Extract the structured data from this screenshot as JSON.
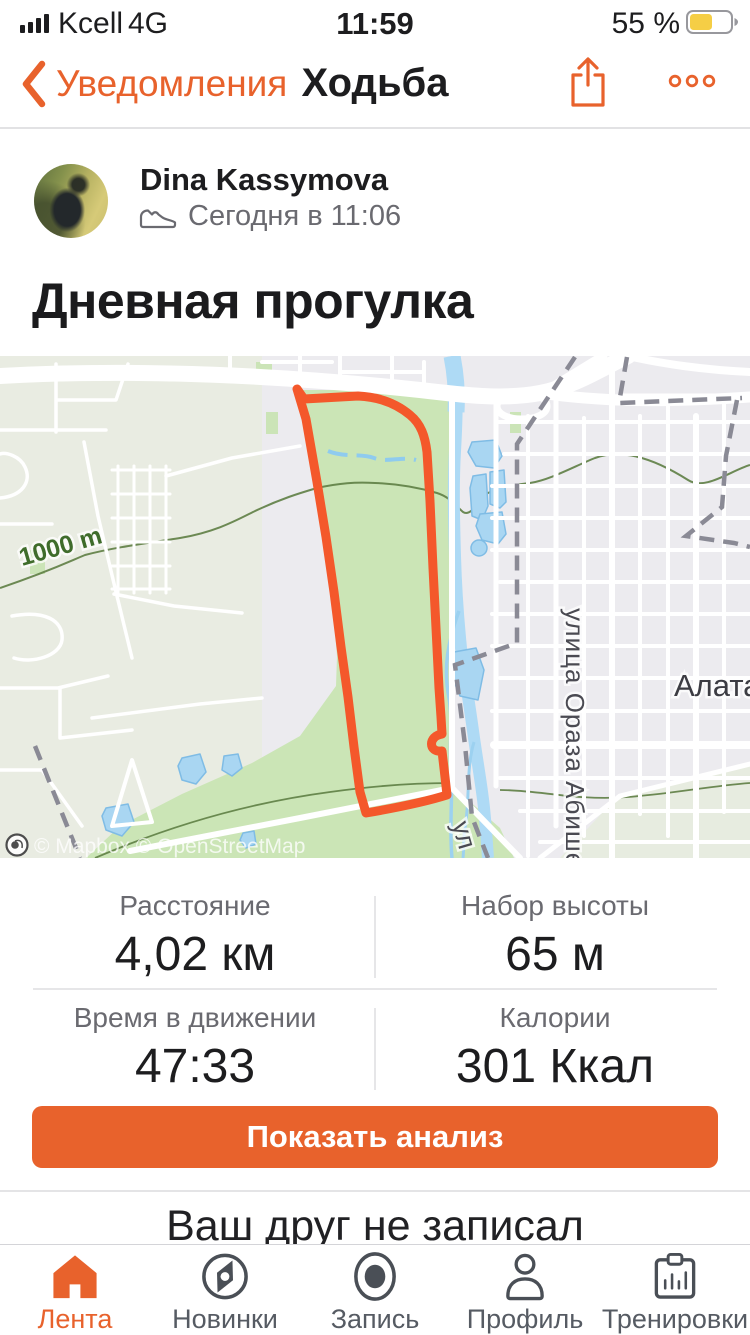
{
  "status_bar": {
    "carrier": "Kcell",
    "network": "4G",
    "time": "11:59",
    "battery_percent": "55 %"
  },
  "nav": {
    "back_label": "Уведомления",
    "title": "Ходьба"
  },
  "activity": {
    "user_name": "Dina Kassymova",
    "date_label": "Сегодня в 11:06",
    "title": "Дневная прогулка"
  },
  "map": {
    "scale_label": "1000 m",
    "street_label": "улица Ораза Абишева",
    "district_label": "Алатауский",
    "street_label_partial": "ул",
    "attribution": "© Mapbox © OpenStreetMap"
  },
  "stats": {
    "items": [
      {
        "label": "Расстояние",
        "value": "4,02 км"
      },
      {
        "label": "Набор высоты",
        "value": "65 м"
      },
      {
        "label": "Время в движении",
        "value": "47:33"
      },
      {
        "label": "Калории",
        "value": "301 Ккал"
      }
    ]
  },
  "actions": {
    "analysis_button": "Показать анализ"
  },
  "feed_next": {
    "partial_text": "Ваш друг не записал"
  },
  "tab_bar": {
    "items": [
      {
        "label": "Лента",
        "active": true
      },
      {
        "label": "Новинки",
        "active": false
      },
      {
        "label": "Запись",
        "active": false
      },
      {
        "label": "Профиль",
        "active": false
      },
      {
        "label": "Тренировки",
        "active": false
      }
    ]
  },
  "colors": {
    "accent": "#E8622C",
    "route": "#F4582B",
    "battery_fill": "#F5CE45",
    "park_green": "#CBE5B6",
    "water_blue": "#AEDAF5"
  }
}
